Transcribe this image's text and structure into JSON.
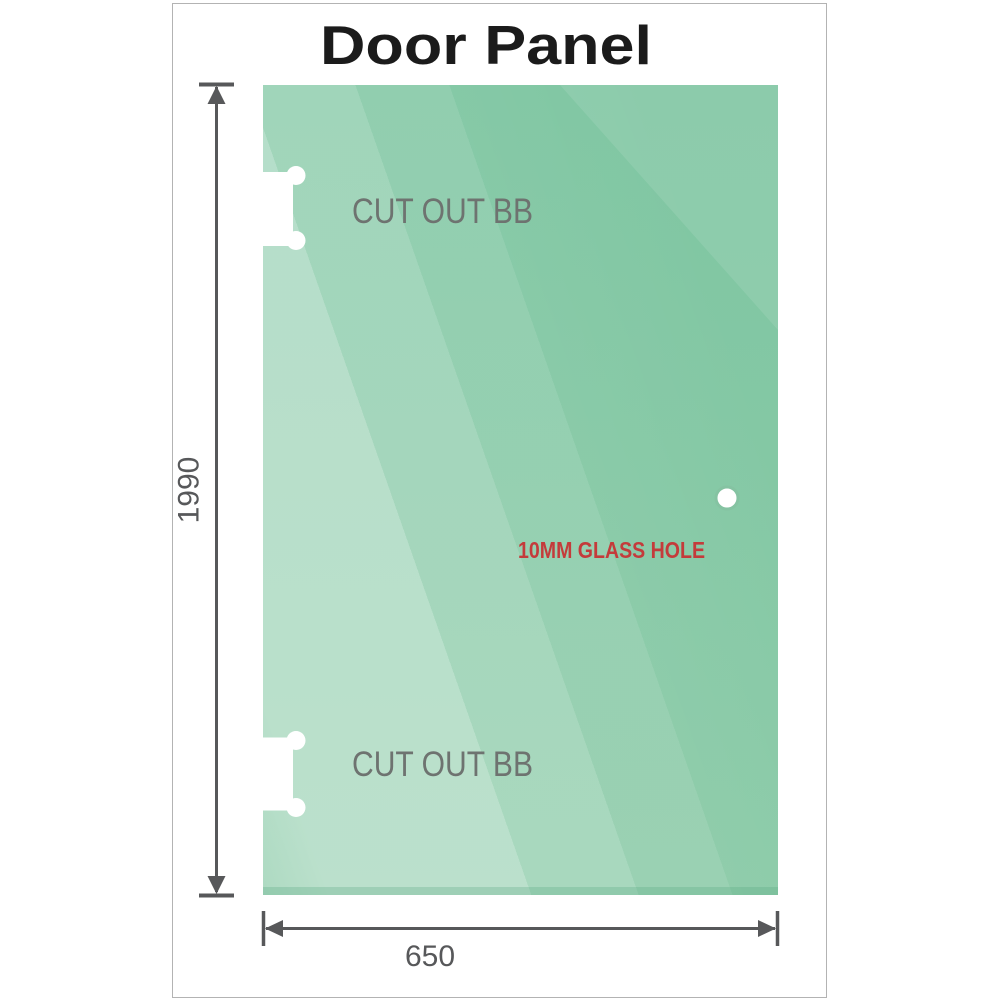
{
  "title": "Door Panel",
  "panel": {
    "cutout_label_top": "CUT OUT BB",
    "cutout_label_bottom": "CUT OUT BB",
    "glass_hole_label": "10MM GLASS HOLE"
  },
  "dimensions": {
    "height": "1990",
    "width": "650"
  },
  "colors": {
    "glass_base_top": "#7fc6a2",
    "glass_base_bottom": "#8acaa7",
    "glass_hole_ring": "#85c3a2",
    "frame_border": "#b3b3b3",
    "title_text": "#1b1b1b",
    "cutout_label_gray": "#6e7370",
    "glass_hole_red": "#c43b3b",
    "dimension_gray": "#57585a"
  }
}
